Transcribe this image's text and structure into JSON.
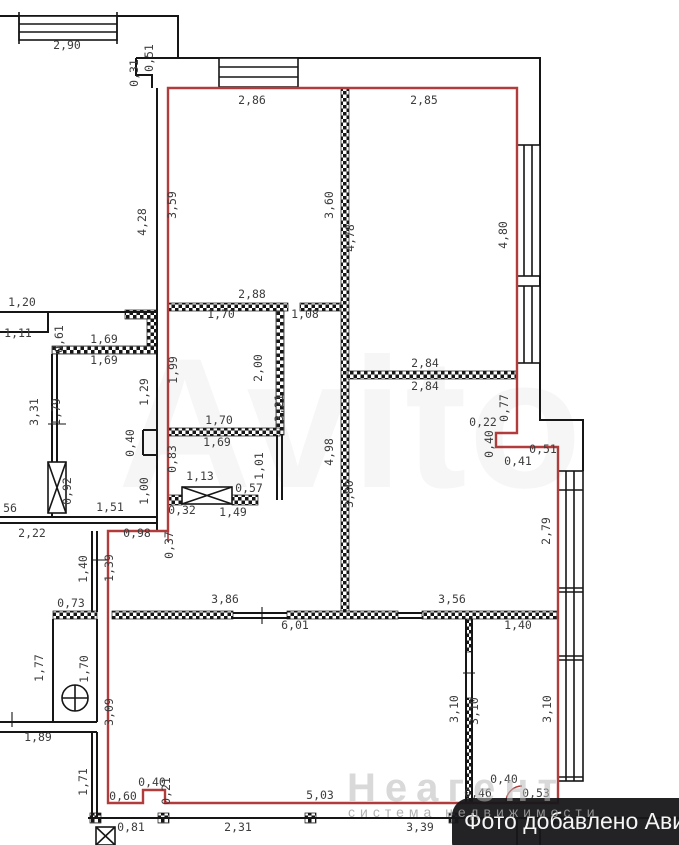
{
  "badge": {
    "text": "Фото добавлено Авито"
  },
  "watermarks": {
    "marketplace_ghost": "Avito",
    "agency_name": "Неагент",
    "agency_tagline": "система недвижимости"
  },
  "colors": {
    "apartment_outline_red": "#b23b3b",
    "wall_black": "#161616",
    "label_gray": "#3d3d3d",
    "badge_background": "#17171a",
    "watermark_gray": "#b9b9b9"
  },
  "plan": {
    "type": "apartment-floor-plan",
    "dimension_labels": [
      {
        "t": "2,90",
        "x": 67,
        "y": 49,
        "r": 0
      },
      {
        "t": "0,31",
        "x": 138,
        "y": 73,
        "r": 1
      },
      {
        "t": "0,51",
        "x": 153,
        "y": 58,
        "r": 1
      },
      {
        "t": "2,86",
        "x": 252,
        "y": 104,
        "r": 0
      },
      {
        "t": "2,85",
        "x": 424,
        "y": 104,
        "r": 0
      },
      {
        "t": "4,28",
        "x": 146,
        "y": 222,
        "r": 1
      },
      {
        "t": "3,59",
        "x": 176,
        "y": 205,
        "r": 1
      },
      {
        "t": "3,60",
        "x": 333,
        "y": 205,
        "r": 1
      },
      {
        "t": "4,78",
        "x": 354,
        "y": 238,
        "r": 1
      },
      {
        "t": "4,80",
        "x": 507,
        "y": 235,
        "r": 1
      },
      {
        "t": "2,88",
        "x": 252,
        "y": 298,
        "r": 0
      },
      {
        "t": "1,70",
        "x": 221,
        "y": 318,
        "r": 0
      },
      {
        "t": "1,08",
        "x": 305,
        "y": 318,
        "r": 0
      },
      {
        "t": "1,20",
        "x": 22,
        "y": 306,
        "r": 0
      },
      {
        "t": "1,11",
        "x": 18,
        "y": 337,
        "r": 0
      },
      {
        "t": "0,61",
        "x": 63,
        "y": 339,
        "r": 1
      },
      {
        "t": "1,69",
        "x": 104,
        "y": 343,
        "r": 0
      },
      {
        "t": "1,69",
        "x": 104,
        "y": 364,
        "r": 0
      },
      {
        "t": "1,99",
        "x": 177,
        "y": 370,
        "r": 1
      },
      {
        "t": "2,00",
        "x": 262,
        "y": 368,
        "r": 1
      },
      {
        "t": "3,21",
        "x": 283,
        "y": 408,
        "r": 1
      },
      {
        "t": "3,31",
        "x": 38,
        "y": 412,
        "r": 1
      },
      {
        "t": "1,79",
        "x": 60,
        "y": 412,
        "r": 1
      },
      {
        "t": "1,29",
        "x": 148,
        "y": 392,
        "r": 1
      },
      {
        "t": "0,40",
        "x": 134,
        "y": 443,
        "r": 1
      },
      {
        "t": "1,70",
        "x": 219,
        "y": 424,
        "r": 0
      },
      {
        "t": "1,69",
        "x": 217,
        "y": 446,
        "r": 0
      },
      {
        "t": "0,83",
        "x": 176,
        "y": 459,
        "r": 1
      },
      {
        "t": "1,13",
        "x": 200,
        "y": 480,
        "r": 0
      },
      {
        "t": "0,57",
        "x": 249,
        "y": 492,
        "r": 0
      },
      {
        "t": "1,01",
        "x": 263,
        "y": 466,
        "r": 1
      },
      {
        "t": "0,92",
        "x": 71,
        "y": 491,
        "r": 1
      },
      {
        "t": "1,00",
        "x": 148,
        "y": 491,
        "r": 1
      },
      {
        "t": "1,51",
        "x": 110,
        "y": 511,
        "r": 0
      },
      {
        "t": "56",
        "x": 10,
        "y": 512,
        "r": 0
      },
      {
        "t": "2,22",
        "x": 32,
        "y": 537,
        "r": 0
      },
      {
        "t": "0,98",
        "x": 137,
        "y": 537,
        "r": 0
      },
      {
        "t": "0,32",
        "x": 182,
        "y": 514,
        "r": 0
      },
      {
        "t": "1,49",
        "x": 233,
        "y": 516,
        "r": 0
      },
      {
        "t": "0,37",
        "x": 173,
        "y": 545,
        "r": 1
      },
      {
        "t": "4,98",
        "x": 333,
        "y": 452,
        "r": 1
      },
      {
        "t": "3,80",
        "x": 353,
        "y": 494,
        "r": 1
      },
      {
        "t": "2,84",
        "x": 425,
        "y": 367,
        "r": 0
      },
      {
        "t": "2,84",
        "x": 425,
        "y": 390,
        "r": 0
      },
      {
        "t": "0,22",
        "x": 483,
        "y": 426,
        "r": 0
      },
      {
        "t": "0,77",
        "x": 508,
        "y": 408,
        "r": 1
      },
      {
        "t": "0,40",
        "x": 493,
        "y": 444,
        "r": 1
      },
      {
        "t": "0,51",
        "x": 543,
        "y": 453,
        "r": 0
      },
      {
        "t": "0,41",
        "x": 518,
        "y": 465,
        "r": 0
      },
      {
        "t": "2,79",
        "x": 550,
        "y": 531,
        "r": 1
      },
      {
        "t": "1,40",
        "x": 87,
        "y": 569,
        "r": 1
      },
      {
        "t": "1,39",
        "x": 113,
        "y": 568,
        "r": 1
      },
      {
        "t": "0,73",
        "x": 71,
        "y": 607,
        "r": 0
      },
      {
        "t": "3,86",
        "x": 225,
        "y": 603,
        "r": 0
      },
      {
        "t": "3,56",
        "x": 452,
        "y": 603,
        "r": 0
      },
      {
        "t": "6,01",
        "x": 295,
        "y": 629,
        "r": 0
      },
      {
        "t": "1,40",
        "x": 518,
        "y": 629,
        "r": 0
      },
      {
        "t": "1,77",
        "x": 43,
        "y": 668,
        "r": 1
      },
      {
        "t": "1,70",
        "x": 88,
        "y": 669,
        "r": 1
      },
      {
        "t": "3,09",
        "x": 113,
        "y": 712,
        "r": 1
      },
      {
        "t": "1,89",
        "x": 38,
        "y": 741,
        "r": 0
      },
      {
        "t": "1,71",
        "x": 87,
        "y": 782,
        "r": 1
      },
      {
        "t": "3,10",
        "x": 458,
        "y": 709,
        "r": 1
      },
      {
        "t": "3,10",
        "x": 478,
        "y": 711,
        "r": 1
      },
      {
        "t": "3,10",
        "x": 551,
        "y": 709,
        "r": 1
      },
      {
        "t": "0,60",
        "x": 123,
        "y": 800,
        "r": 0
      },
      {
        "t": "0,40",
        "x": 152,
        "y": 786,
        "r": 0
      },
      {
        "t": "0,21",
        "x": 170,
        "y": 791,
        "r": 1
      },
      {
        "t": "5,03",
        "x": 320,
        "y": 799,
        "r": 0
      },
      {
        "t": "0,40",
        "x": 504,
        "y": 783,
        "r": 0
      },
      {
        "t": "0,46",
        "x": 478,
        "y": 797,
        "r": 0
      },
      {
        "t": "0,53",
        "x": 536,
        "y": 797,
        "r": 0
      },
      {
        "t": "0,81",
        "x": 131,
        "y": 831,
        "r": 0
      },
      {
        "t": "2,31",
        "x": 238,
        "y": 831,
        "r": 0
      },
      {
        "t": "3,39",
        "x": 420,
        "y": 831,
        "r": 0
      }
    ]
  }
}
